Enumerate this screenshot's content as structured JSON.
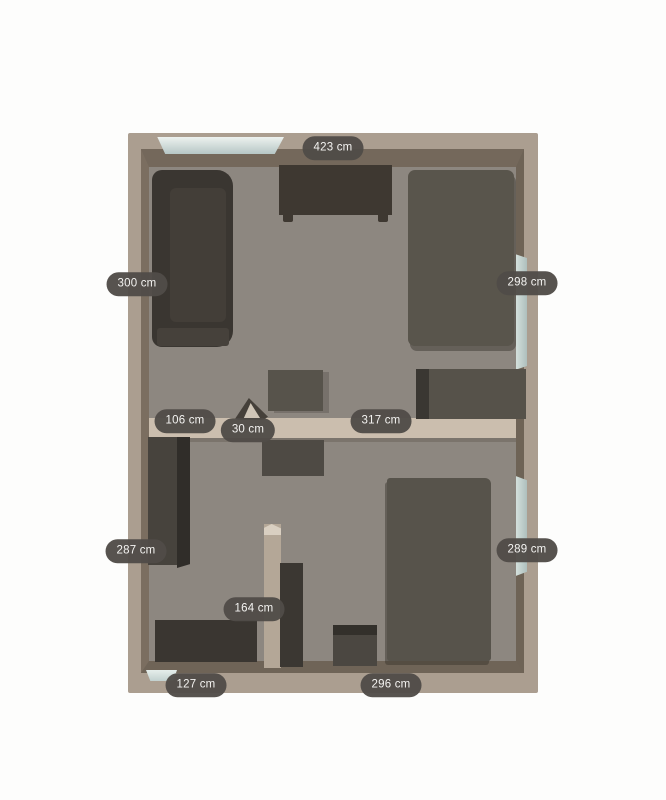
{
  "app": {
    "background": "#fdfdfc"
  },
  "floorplan": {
    "outer_wall": {
      "name": "outer-wall-band",
      "x": 128,
      "y": 133,
      "w": 410,
      "h": 560,
      "color": "#ab9e90",
      "r": "2px",
      "interactable": true
    },
    "inner_frame": {
      "name": "wall-inner-faces",
      "x": 141,
      "y": 149,
      "w": 383,
      "h": 524,
      "floor_color": "#8d8780",
      "bt": 18,
      "bl": 8,
      "br": 8,
      "bb": 12,
      "ct": "#74685b",
      "cl": "#7b6e60",
      "cr": "#6e6356",
      "cb": "#6f6457",
      "interactable": false
    },
    "windows": [
      {
        "name": "window-top",
        "x": 152,
        "y": 137,
        "w": 132,
        "h": 17,
        "grad": "linear-gradient(180deg,#edf2ef 0%,#b6c6c5 100%)",
        "clip": "polygon(4% 0,100% 0,93% 100%,10% 100%)",
        "interactable": true
      },
      {
        "name": "window-right-upper",
        "x": 516,
        "y": 252,
        "w": 11,
        "h": 120,
        "grad": "linear-gradient(90deg,#d4e0dc,#aebfbd)",
        "clip": "polygon(0 2%,100% 5%,100% 95%,0 98%)",
        "interactable": true
      },
      {
        "name": "window-right-lower",
        "x": 516,
        "y": 474,
        "w": 11,
        "h": 104,
        "grad": "linear-gradient(90deg,#d4e0dc,#aebfbd)",
        "clip": "polygon(0 2%,100% 6%,100% 94%,0 98%)",
        "interactable": true
      },
      {
        "name": "window-bottom-left",
        "x": 146,
        "y": 670,
        "w": 31,
        "h": 11,
        "grad": "linear-gradient(180deg,#e6eeeb,#c2d1cf)",
        "clip": "polygon(0 0,100% 0,88% 100%,14% 100%)",
        "interactable": true
      }
    ],
    "interior_walls": [
      {
        "name": "middle-wall",
        "x": 149,
        "y": 418,
        "w": 367,
        "h": 20,
        "color": "#cbbeae",
        "interactable": true
      },
      {
        "name": "middle-wall-shadow",
        "x": 149,
        "y": 438,
        "w": 367,
        "h": 4,
        "color": "rgba(58,48,38,0.22)",
        "interactable": false
      },
      {
        "name": "partition-wall",
        "x": 264,
        "y": 524,
        "w": 17,
        "h": 144,
        "color": "#b4a797",
        "interactable": true
      },
      {
        "name": "partition-wall-cap",
        "x": 264,
        "y": 524,
        "w": 17,
        "h": 11,
        "color": "#d9cfc1",
        "clip": "polygon(0 100%,0 35%,45% 0,100% 40%,100% 100%)",
        "interactable": false
      }
    ],
    "furniture": [
      {
        "name": "sofa",
        "x": 152,
        "y": 170,
        "w": 81,
        "h": 177,
        "color": "#3a3631",
        "r": "10px 16px 16px 10px",
        "interactable": true
      },
      {
        "name": "sofa-seat-cushion",
        "x": 170,
        "y": 188,
        "w": 56,
        "h": 134,
        "color": "#433e38",
        "r": "6px",
        "interactable": false
      },
      {
        "name": "sofa-front-edge",
        "x": 157,
        "y": 328,
        "w": 72,
        "h": 18,
        "color": "#46413b",
        "r": "3px",
        "interactable": false
      },
      {
        "name": "desk-top-wall",
        "x": 279,
        "y": 165,
        "w": 113,
        "h": 50,
        "color": "#3e3831",
        "interactable": true
      },
      {
        "name": "desk-foot-left",
        "x": 283,
        "y": 215,
        "w": 10,
        "h": 7,
        "color": "#3e3831",
        "r": "0 0 2px 2px",
        "interactable": false
      },
      {
        "name": "desk-foot-right",
        "x": 378,
        "y": 215,
        "w": 10,
        "h": 7,
        "color": "#3e3831",
        "r": "0 0 2px 2px",
        "interactable": false
      },
      {
        "name": "bed-upper-room",
        "x": 408,
        "y": 170,
        "w": 106,
        "h": 176,
        "color": "#59554c",
        "r": "7px",
        "shadow": "2px 5px 0 rgba(54,49,42,0.45)",
        "interactable": true
      },
      {
        "name": "dresser-right-wall",
        "x": 416,
        "y": 369,
        "w": 110,
        "h": 50,
        "color": "#56524a",
        "interactable": true
      },
      {
        "name": "dresser-right-side-face",
        "x": 416,
        "y": 369,
        "w": 13,
        "h": 50,
        "color": "#3a3732",
        "interactable": false
      },
      {
        "name": "side-table-upper",
        "x": 268,
        "y": 370,
        "w": 55,
        "h": 41,
        "color": "#57534b",
        "shadow": "6px 2px 0 rgba(54,49,42,0.25)",
        "interactable": true
      },
      {
        "name": "side-table-lower",
        "x": 262,
        "y": 440,
        "w": 62,
        "h": 36,
        "color": "#4e4a44",
        "interactable": true
      },
      {
        "name": "wardrobe-left",
        "x": 148,
        "y": 437,
        "w": 29,
        "h": 128,
        "color": "#47433d",
        "interactable": true
      },
      {
        "name": "wardrobe-left-side-face",
        "x": 177,
        "y": 437,
        "w": 13,
        "h": 131,
        "color": "#302d29",
        "clip": "polygon(0 0,100% 0,100% 97%,0 100%)",
        "interactable": false
      },
      {
        "name": "tall-cabinet-partition",
        "x": 280,
        "y": 563,
        "w": 23,
        "h": 104,
        "color": "#3b3732",
        "interactable": true
      },
      {
        "name": "dresser-bottom-left-room",
        "x": 155,
        "y": 620,
        "w": 102,
        "h": 42,
        "color": "#3a3631",
        "interactable": true
      },
      {
        "name": "stool-bottom-center",
        "x": 333,
        "y": 625,
        "w": 44,
        "h": 41,
        "color": "#4b4741",
        "interactable": true
      },
      {
        "name": "stool-top-edge",
        "x": 333,
        "y": 625,
        "w": 44,
        "h": 10,
        "color": "#33302b",
        "interactable": false
      },
      {
        "name": "bed-lower-room",
        "x": 387,
        "y": 478,
        "w": 104,
        "h": 183,
        "color": "#57534b",
        "r": "3px 6px 3px 3px",
        "shadow": "-2px 4px 0 rgba(54,49,42,0.45)",
        "interactable": true
      },
      {
        "name": "door-leaf",
        "x": 235,
        "y": 398,
        "w": 33,
        "h": 22,
        "color": "#45403a",
        "clip": "polygon(0 95%,42% 0,100% 85%,85% 100%,10% 100%)",
        "interactable": true
      },
      {
        "name": "door-swing-face",
        "x": 243,
        "y": 403,
        "w": 17,
        "h": 15,
        "color": "#cfc5b7",
        "clip": "polygon(5% 100%,45% 0,100% 100%)",
        "interactable": false
      }
    ]
  },
  "dimension_labels": [
    {
      "text": "423 cm",
      "x": 333,
      "y": 148
    },
    {
      "text": "300 cm",
      "x": 137,
      "y": 284
    },
    {
      "text": "298 cm",
      "x": 527,
      "y": 283
    },
    {
      "text": "106 cm",
      "x": 185,
      "y": 421
    },
    {
      "text": "30 cm",
      "x": 248,
      "y": 430
    },
    {
      "text": "317 cm",
      "x": 381,
      "y": 421
    },
    {
      "text": "287 cm",
      "x": 136,
      "y": 551
    },
    {
      "text": "289 cm",
      "x": 527,
      "y": 550
    },
    {
      "text": "164 cm",
      "x": 254,
      "y": 609
    },
    {
      "text": "127 cm",
      "x": 196,
      "y": 685
    },
    {
      "text": "296 cm",
      "x": 391,
      "y": 685
    }
  ]
}
